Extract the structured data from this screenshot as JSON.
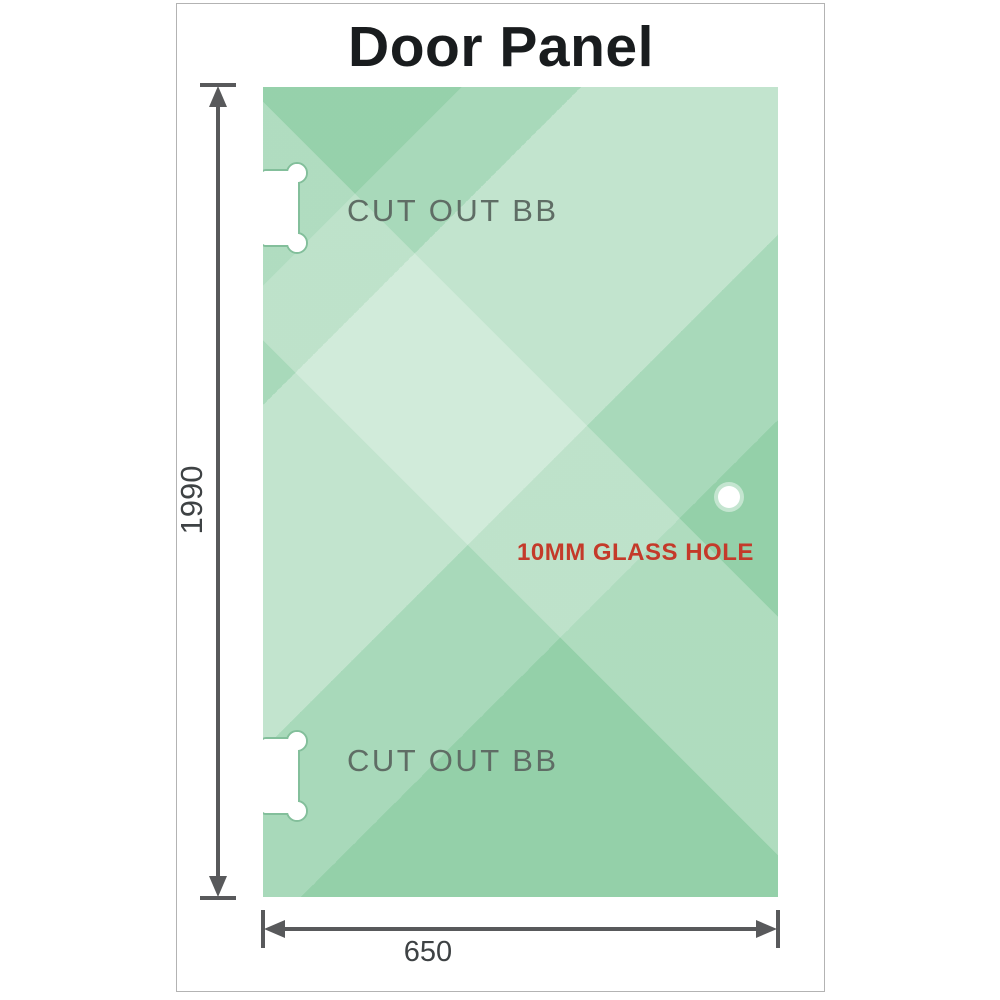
{
  "title": "Door Panel",
  "panel": {
    "cutouts": [
      {
        "label": "CUT OUT BB",
        "position": "top-left"
      },
      {
        "label": "CUT OUT BB",
        "position": "bottom-left"
      }
    ],
    "hole": {
      "label": "10MM GLASS HOLE"
    }
  },
  "dimensions": {
    "height": {
      "value": "1990",
      "side": "left"
    },
    "width": {
      "value": "650",
      "side": "bottom"
    }
  },
  "colors": {
    "glass_base": "#90cea6",
    "glass_highlight": "#cdead3",
    "title_text": "#191c1e",
    "cutout_text": "#5f6d65",
    "hole_label_text": "#c43a2a",
    "dimension_lines": "#58595b",
    "dimension_text": "#3e4244",
    "frame_border": "#b3b3b3"
  }
}
